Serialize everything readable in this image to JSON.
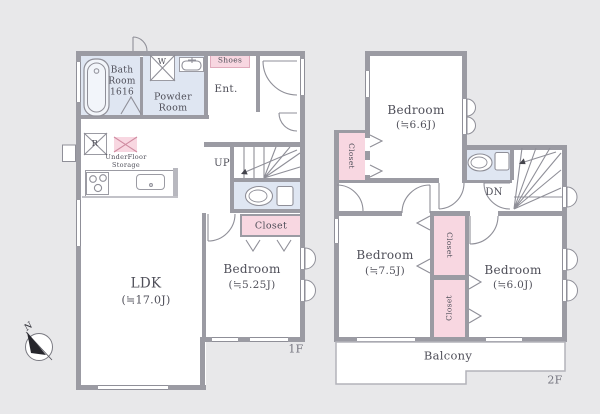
{
  "palette": {
    "background": "#e8e8ea",
    "wall": "#9b9ba3",
    "wet_area": "#dfe6f2",
    "closet_pink": "#f8d7e1",
    "label_text": "#4f4f59"
  },
  "floor1": {
    "floor_label": "1F",
    "bath_room": {
      "l1": "Bath",
      "l2": "Room",
      "l3": "1616"
    },
    "powder_room": {
      "l1": "Powder",
      "l2": "Room"
    },
    "shoes_label": "Shoes",
    "entrance_label": "Ent.",
    "up_label": "UP",
    "underfloor_storage": {
      "l1": "UnderFloor",
      "l2": "Storage"
    },
    "closet_label": "Closet",
    "washer_label": "W",
    "fridge_label": "R",
    "ldk": {
      "name": "LDK",
      "size": "(≒17.0J)"
    },
    "bedroom": {
      "name": "Bedroom",
      "size": "(≒5.25J)"
    }
  },
  "floor2": {
    "floor_label": "2F",
    "bedroom_66": {
      "name": "Bedroom",
      "size": "(≒6.6J)"
    },
    "bedroom_75": {
      "name": "Bedroom",
      "size": "(≒7.5J)"
    },
    "bedroom_60": {
      "name": "Bedroom",
      "size": "(≒6.0J)"
    },
    "closet_top_label": "Closet",
    "closet_a_label": "Closet",
    "closet_b_label": "Closet",
    "down_label": "DN",
    "balcony_label": "Balcony"
  },
  "compass": {
    "north_label": "N"
  }
}
